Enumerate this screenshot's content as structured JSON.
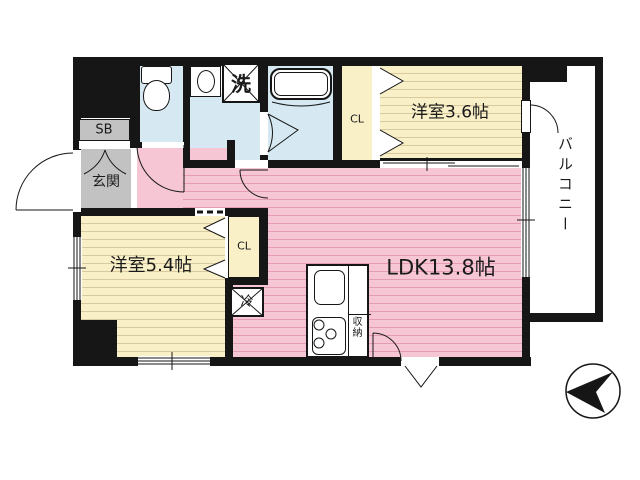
{
  "plan": {
    "type": "apartment-floor-plan",
    "rooms": {
      "ldk": "LDK13.8帖",
      "western_room_3_6": "洋室3.6帖",
      "western_room_5_4": "洋室5.4帖",
      "entrance": "玄関",
      "shoe_box": "SB",
      "closet_upper": "CL",
      "closet_lower": "CL",
      "laundry": "洗",
      "refrigerator": "冷",
      "kitchen_storage": "収納",
      "balcony": "バルコニー"
    },
    "colors": {
      "wall": "#161616",
      "ldk_pink": "#f7c6d5",
      "pink_stripe": "#e49cb7",
      "room_cream": "#faf0c8",
      "cream_stripe": "#d8c9a0",
      "wet_area_blue": "#d6e9f2",
      "entrance_gray": "#c2c2c2",
      "background": "#ffffff"
    },
    "compass": {
      "icon": "north-arrow",
      "points": "left"
    }
  }
}
